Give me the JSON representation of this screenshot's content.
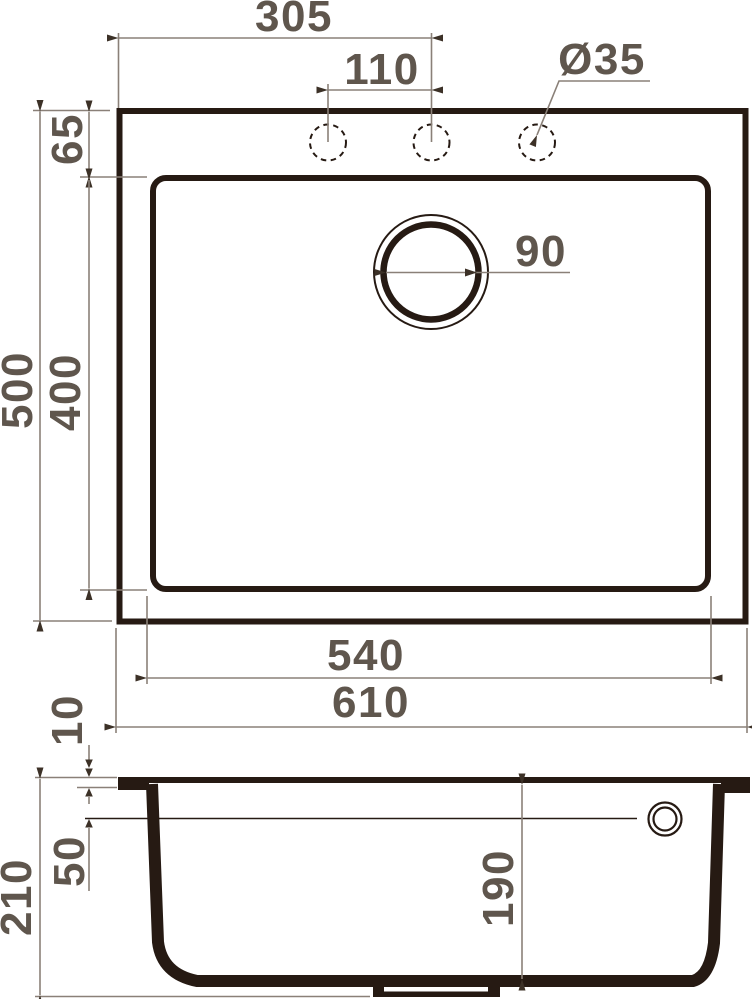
{
  "dimensions": {
    "top_view": {
      "center_from_left": "305",
      "hole_spacing": "110",
      "hole_diameter": "Ø35",
      "top_edge_to_bowl": "65",
      "overall_depth": "500",
      "bowl_depth": "400",
      "drain_diameter": "90",
      "bowl_width": "540",
      "overall_width": "610"
    },
    "section_view": {
      "rim_thickness": "10",
      "top_to_overflow": "50",
      "overall_height": "210",
      "bowl_inner_depth": "190"
    }
  },
  "colors": {
    "ink": "#261a13",
    "dim_line": "#8a8078",
    "dim_text": "#5f564d",
    "arrow": "#3c3127",
    "background": "#ffffff"
  }
}
